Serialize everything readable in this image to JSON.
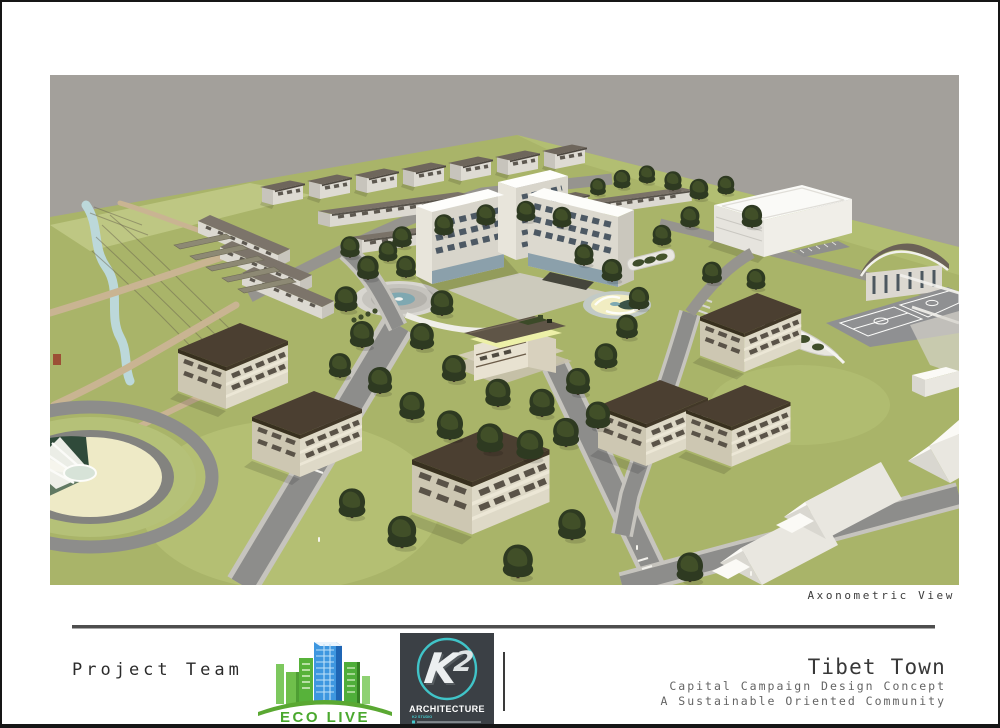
{
  "board": {
    "view_caption": "Axonometric View",
    "footer": {
      "team_label": "Project Team",
      "project_title": "Tibet Town",
      "project_subtitle_1": "Capital Campaign Design Concept",
      "project_subtitle_2": "A Sustainable Oriented Community"
    },
    "logos": {
      "eco_live": {
        "name": "ECO LIVE",
        "tagline": "CONSTRUCTION AND MANAGEMENT LLC"
      },
      "k2": {
        "monogram_k": "K",
        "monogram_2": "2",
        "label": "ARCHITECTURE",
        "studio": "K2 STUDIO"
      }
    },
    "scene": {
      "type": "3d-axonometric-site-render",
      "colors": {
        "sky": "#a3a09b",
        "grass": "#a9b469",
        "road": "#8d8d8b",
        "dorm_roof": "#4b3f31",
        "tree_canopy": "#2e3a21",
        "water": "#bcd8da",
        "white_building": "#fbfaf6"
      }
    }
  }
}
